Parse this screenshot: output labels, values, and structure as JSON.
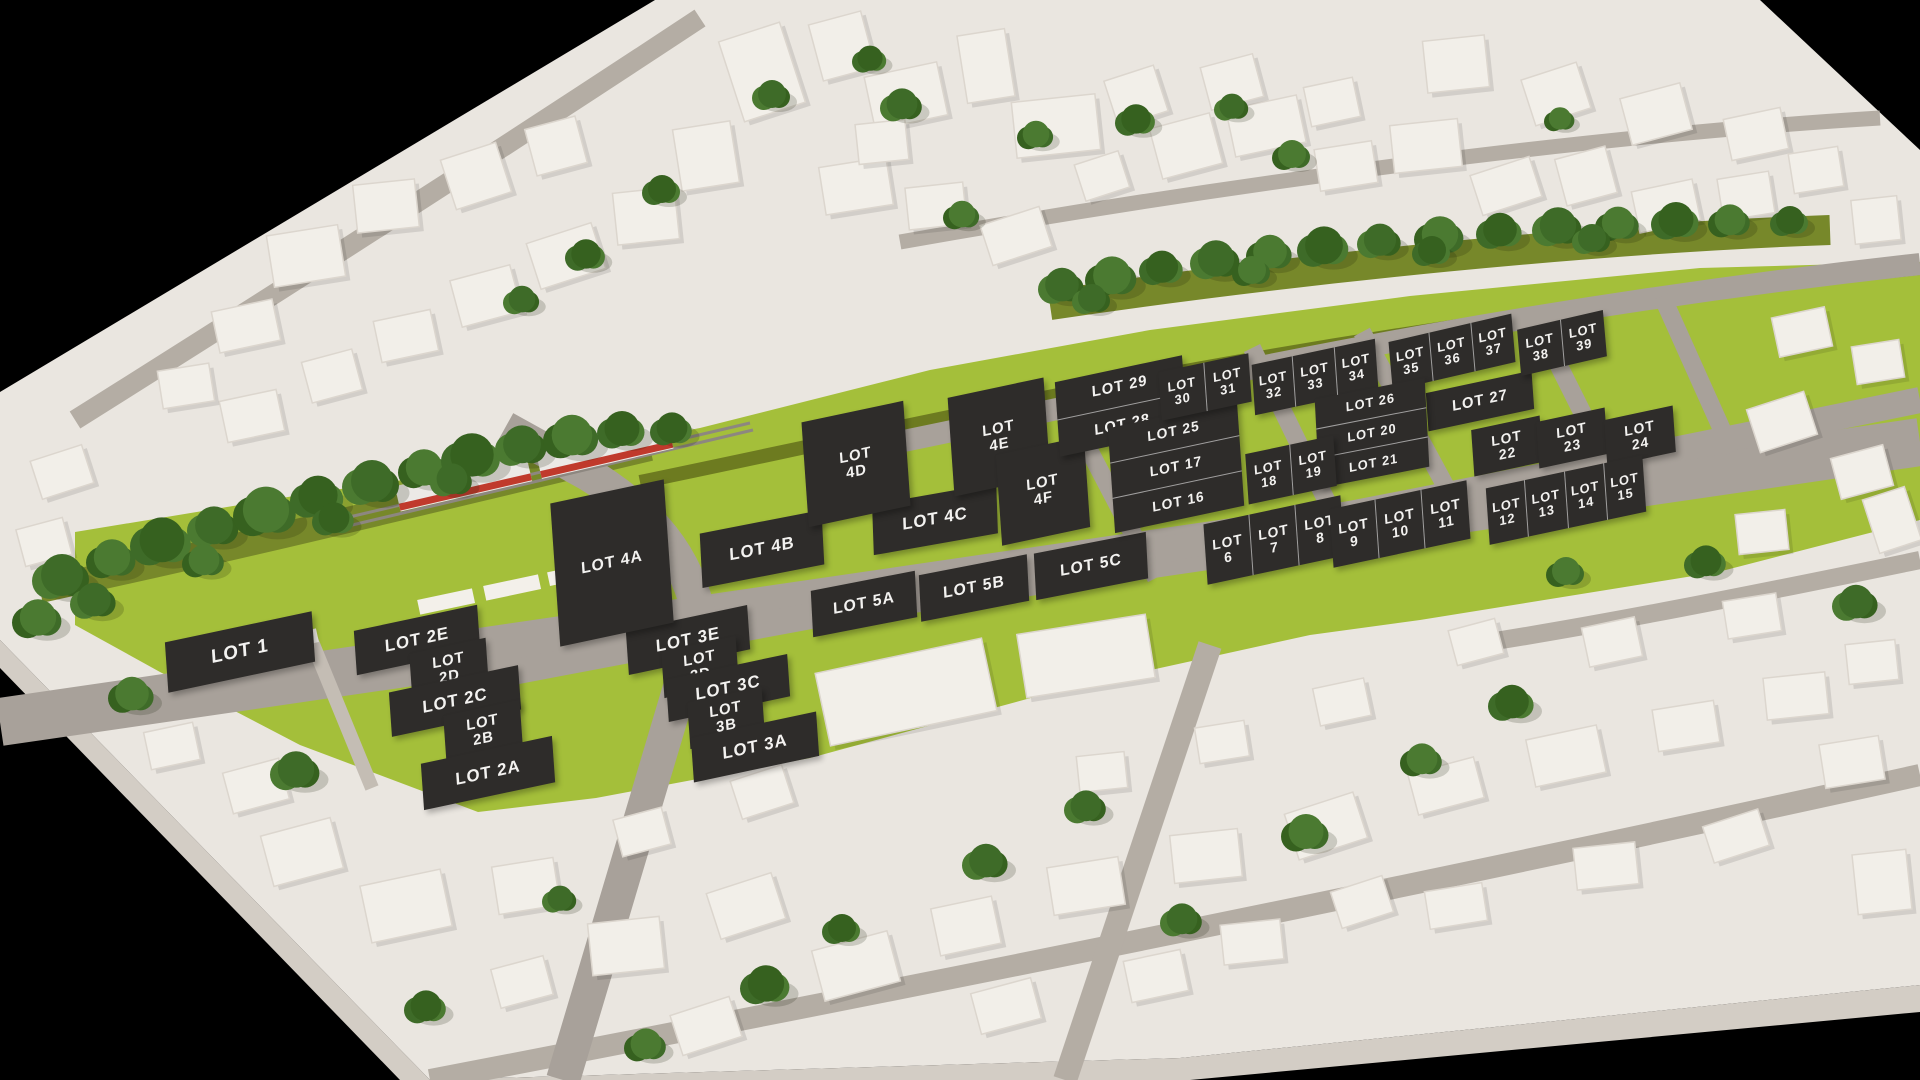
{
  "scene": {
    "background": "#000000",
    "terrain_color": "#eae6e0",
    "grass_color": "#a4bf3a",
    "verge_color": "#6d7b20",
    "road_color": "#a8a19a",
    "city_road_color": "#b4ada4",
    "building_color": "#f2efe9",
    "tree_color": "#3e6b28",
    "plate_color": "#2e2c2a",
    "plate_text_color": "#f3f2f0",
    "train_body_color": "#ece9e6",
    "train_stripe_color": "#c03a2c"
  },
  "lots": {
    "plates": [
      {
        "label": "LOT 1",
        "x": 240,
        "y": 652,
        "w": 150,
        "h": 50,
        "rot": -12,
        "fs": 19
      },
      {
        "label": "LOT 2E",
        "x": 417,
        "y": 640,
        "w": 126,
        "h": 44,
        "rot": -12,
        "fs": 17
      },
      {
        "label": "LOT 2D",
        "x": 449,
        "y": 669,
        "w": 78,
        "h": 46,
        "rot": -12,
        "fs": 15,
        "wrap": true
      },
      {
        "label": "LOT 2C",
        "x": 455,
        "y": 701,
        "w": 132,
        "h": 44,
        "rot": -12,
        "fs": 17
      },
      {
        "label": "LOT 2B",
        "x": 483,
        "y": 731,
        "w": 78,
        "h": 46,
        "rot": -12,
        "fs": 15,
        "wrap": true
      },
      {
        "label": "LOT 2A",
        "x": 488,
        "y": 773,
        "w": 134,
        "h": 46,
        "rot": -12,
        "fs": 17
      },
      {
        "label": "LOT 3E",
        "x": 688,
        "y": 640,
        "w": 124,
        "h": 44,
        "rot": -12,
        "fs": 17
      },
      {
        "label": "LOT 3D",
        "x": 700,
        "y": 667,
        "w": 76,
        "h": 46,
        "rot": -12,
        "fs": 15,
        "wrap": true
      },
      {
        "label": "LOT 3C",
        "x": 728,
        "y": 688,
        "w": 124,
        "h": 42,
        "rot": -12,
        "fs": 17
      },
      {
        "label": "LOT 3B",
        "x": 726,
        "y": 718,
        "w": 76,
        "h": 46,
        "rot": -12,
        "fs": 15,
        "wrap": true
      },
      {
        "label": "LOT 3A",
        "x": 755,
        "y": 747,
        "w": 128,
        "h": 44,
        "rot": -12,
        "fs": 17
      },
      {
        "label": "LOT 4A",
        "x": 612,
        "y": 563,
        "w": 116,
        "h": 142,
        "rot": -12,
        "fs": 16
      },
      {
        "label": "LOT 4B",
        "x": 762,
        "y": 549,
        "w": 124,
        "h": 54,
        "rot": -11,
        "fs": 17
      },
      {
        "label": "LOT 4C",
        "x": 935,
        "y": 519,
        "w": 126,
        "h": 50,
        "rot": -10,
        "fs": 17
      },
      {
        "label": "LOT 4D",
        "x": 856,
        "y": 464,
        "w": 104,
        "h": 104,
        "rot": -12,
        "fs": 15,
        "wrap": true
      },
      {
        "label": "LOT 4E",
        "x": 999,
        "y": 437,
        "w": 98,
        "h": 98,
        "rot": -12,
        "fs": 15,
        "wrap": true
      },
      {
        "label": "LOT 4F",
        "x": 1043,
        "y": 491,
        "w": 90,
        "h": 90,
        "rot": -12,
        "fs": 15,
        "wrap": true
      },
      {
        "label": "LOT 5A",
        "x": 864,
        "y": 604,
        "w": 106,
        "h": 46,
        "rot": -11,
        "fs": 16
      },
      {
        "label": "LOT 5B",
        "x": 974,
        "y": 588,
        "w": 110,
        "h": 46,
        "rot": -11,
        "fs": 16
      },
      {
        "label": "LOT 5C",
        "x": 1091,
        "y": 566,
        "w": 114,
        "h": 46,
        "rot": -11,
        "fs": 16
      },
      {
        "label": "LOT 27",
        "x": 1480,
        "y": 401,
        "w": 108,
        "h": 38,
        "rot": -12,
        "fs": 15
      },
      {
        "label": "LOT 22",
        "x": 1507,
        "y": 446,
        "w": 70,
        "h": 46,
        "rot": -12,
        "fs": 14,
        "wrap": true
      },
      {
        "label": "LOT 23",
        "x": 1572,
        "y": 438,
        "w": 70,
        "h": 46,
        "rot": -12,
        "fs": 14,
        "wrap": true
      },
      {
        "label": "LOT 24",
        "x": 1640,
        "y": 436,
        "w": 70,
        "h": 46,
        "rot": -12,
        "fs": 14,
        "wrap": true
      }
    ],
    "groups": [
      {
        "labels": [
          "LOT 29",
          "LOT 28"
        ],
        "dir": "rows",
        "x": 1121,
        "y": 406,
        "w": 130,
        "h": 74,
        "rot": -12,
        "fs": 15
      },
      {
        "labels": [
          "LOT 25",
          "LOT 17",
          "LOT 16"
        ],
        "dir": "rows",
        "x": 1176,
        "y": 467,
        "w": 132,
        "h": 104,
        "rot": -12,
        "fs": 14
      },
      {
        "labels": [
          "LOT 30",
          "LOT 31"
        ],
        "dir": "cols",
        "x": 1205,
        "y": 387,
        "w": 92,
        "h": 48,
        "rot": -12,
        "fs": 13,
        "wrap": true
      },
      {
        "labels": [
          "LOT 32",
          "LOT 33",
          "LOT 34"
        ],
        "dir": "cols",
        "x": 1315,
        "y": 377,
        "w": 126,
        "h": 50,
        "rot": -12,
        "fs": 13,
        "wrap": true
      },
      {
        "labels": [
          "LOT 35",
          "LOT 36",
          "LOT 37"
        ],
        "dir": "cols",
        "x": 1452,
        "y": 352,
        "w": 126,
        "h": 48,
        "rot": -13,
        "fs": 13,
        "wrap": true
      },
      {
        "labels": [
          "LOT 38",
          "LOT 39"
        ],
        "dir": "cols",
        "x": 1562,
        "y": 343,
        "w": 88,
        "h": 46,
        "rot": -13,
        "fs": 13,
        "wrap": true
      },
      {
        "labels": [
          "LOT 26",
          "LOT 20",
          "LOT 21"
        ],
        "dir": "rows",
        "x": 1372,
        "y": 433,
        "w": 112,
        "h": 88,
        "rot": -11,
        "fs": 13
      },
      {
        "labels": [
          "LOT 18",
          "LOT 19"
        ],
        "dir": "cols",
        "x": 1291,
        "y": 470,
        "w": 90,
        "h": 50,
        "rot": -12,
        "fs": 13,
        "wrap": true
      },
      {
        "labels": [
          "LOT 6",
          "LOT 7",
          "LOT 8"
        ],
        "dir": "cols",
        "x": 1274,
        "y": 540,
        "w": 140,
        "h": 60,
        "rot": -12,
        "fs": 14,
        "wrap": true
      },
      {
        "labels": [
          "LOT 9",
          "LOT 10",
          "LOT 11"
        ],
        "dir": "cols",
        "x": 1400,
        "y": 524,
        "w": 140,
        "h": 58,
        "rot": -12,
        "fs": 14,
        "wrap": true
      },
      {
        "labels": [
          "LOT 12",
          "LOT 13",
          "LOT 14",
          "LOT 15"
        ],
        "dir": "cols",
        "x": 1566,
        "y": 500,
        "w": 160,
        "h": 56,
        "rot": -12,
        "fs": 13,
        "wrap": true
      }
    ]
  }
}
